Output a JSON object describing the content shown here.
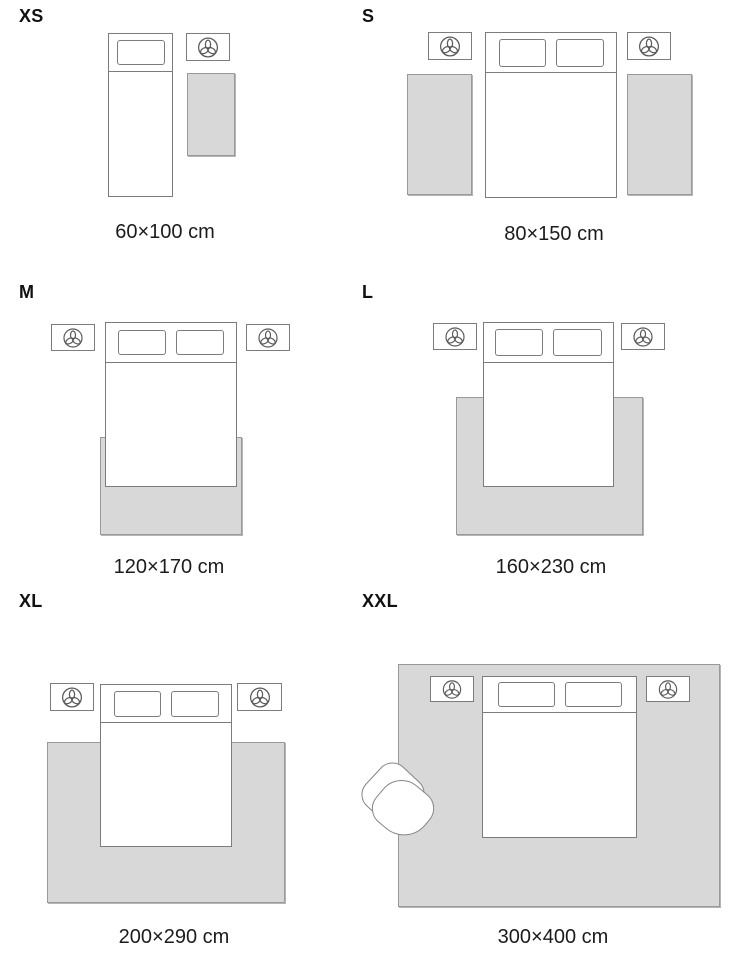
{
  "colors": {
    "background": "#ffffff",
    "rug_fill": "#d8d8d8",
    "rug_border": "#999999",
    "line": "#7c7c7c",
    "text": "#1c1c1c"
  },
  "icons": {
    "nightstand_decor": "plant-icon"
  },
  "sizes": [
    {
      "id": "xs",
      "label": "XS",
      "dimensions": "60×100 cm"
    },
    {
      "id": "s",
      "label": "S",
      "dimensions": "80×150 cm"
    },
    {
      "id": "m",
      "label": "M",
      "dimensions": "120×170 cm"
    },
    {
      "id": "l",
      "label": "L",
      "dimensions": "160×230 cm"
    },
    {
      "id": "xl",
      "label": "XL",
      "dimensions": "200×290 cm"
    },
    {
      "id": "xxl",
      "label": "XXL",
      "dimensions": "300×400 cm"
    }
  ]
}
